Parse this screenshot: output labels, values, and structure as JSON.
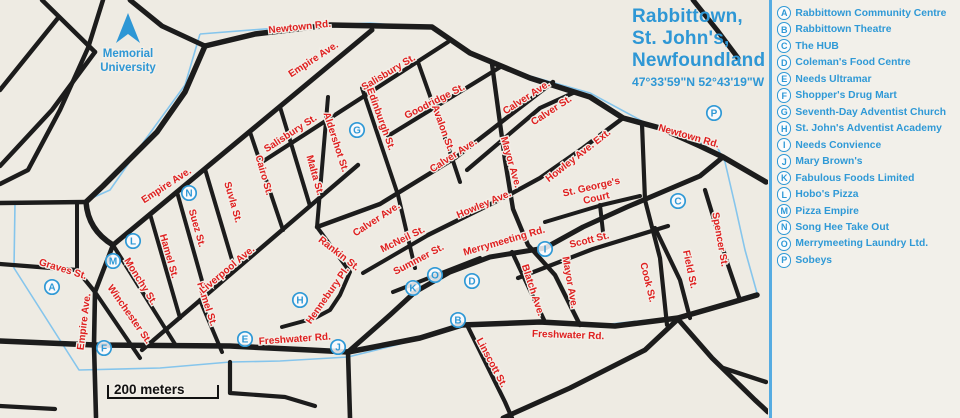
{
  "title": {
    "line1": "Rabbittown,",
    "line2": "St. John's,",
    "line3": "Newfoundland",
    "coordinates": "47°33'59\"N 52°43'19\"W"
  },
  "legend": {
    "items": [
      {
        "letter": "A",
        "label": "Rabbittown Community Centre"
      },
      {
        "letter": "B",
        "label": "Rabbittown Theatre"
      },
      {
        "letter": "C",
        "label": "The HUB"
      },
      {
        "letter": "D",
        "label": "Coleman's Food Centre"
      },
      {
        "letter": "E",
        "label": "Needs Ultramar"
      },
      {
        "letter": "F",
        "label": "Shopper's Drug Mart"
      },
      {
        "letter": "G",
        "label": "Seventh-Day Adventist Church"
      },
      {
        "letter": "H",
        "label": "St. John's Adventist Academy"
      },
      {
        "letter": "I",
        "label": "Needs Convience"
      },
      {
        "letter": "J",
        "label": "Mary Brown's"
      },
      {
        "letter": "K",
        "label": "Fabulous Foods Limited"
      },
      {
        "letter": "L",
        "label": "Hobo's Pizza"
      },
      {
        "letter": "M",
        "label": "Pizza Empire"
      },
      {
        "letter": "N",
        "label": "Song Hee Take Out"
      },
      {
        "letter": "O",
        "label": "Merrymeeting Laundry Ltd."
      },
      {
        "letter": "P",
        "label": "Sobeys"
      }
    ]
  },
  "map": {
    "colors": {
      "background": "#eeebe3",
      "road": "#1c1c1c",
      "boundary": "#85c5ec",
      "street_label": "#df1f1f",
      "marker": "#2f99d6",
      "halo": "#f2efe8"
    },
    "memorial": {
      "lines": [
        "Memorial",
        "University"
      ],
      "x": 128,
      "y": 57,
      "line_height": 14
    },
    "north_arrow": {
      "points": "128,13 116,43 128,34 140,43"
    },
    "scale_bar": {
      "text": "200 meters",
      "path": "M108,385 L108,398 L218,398 L218,385",
      "text_x": 114,
      "text_y": 394
    },
    "boundary_points": "200,34 290,27 370,23 432,28 470,52 530,76 590,93 655,128 700,143 717,147 725,162 735,205 745,250 757,293 677,317 610,324 530,321 460,324 400,344 348,357 280,361 230,362 160,368 79,370 14,268 15,203 83,202 110,190 145,140 185,85 200,34",
    "roads": [
      {
        "d": "M42,0 L95,52",
        "w": 4.5
      },
      {
        "d": "M58,18 L0,90",
        "w": 4.5
      },
      {
        "d": "M95,52 L52,110 L0,166",
        "w": 4.5
      },
      {
        "d": "M103,0 L88,48 L60,110 L28,170 L0,184",
        "w": 4.5
      },
      {
        "d": "M130,0 L162,26 L205,46",
        "w": 5
      },
      {
        "d": "M205,46 L185,92 L157,132 L103,186 L86,202 Q88,230 113,245",
        "w": 5.5
      },
      {
        "d": "M86,202 L0,203",
        "w": 4.5
      },
      {
        "d": "M77,203 L77,269",
        "w": 4
      },
      {
        "d": "M0,264 L77,270 L95,292",
        "w": 4.2
      },
      {
        "d": "M113,245 L95,292 L94,345 L96,417",
        "w": 4.6
      },
      {
        "d": "M95,292 L140,358",
        "w": 4
      },
      {
        "d": "M113,245 L175,344",
        "w": 4
      },
      {
        "d": "M200,300 L222,352",
        "w": 4
      },
      {
        "d": "M205,46 L255,34 L330,25 L432,27 L470,53 L530,78 L590,97 L623,118 L660,128 L700,146 L723,157 L766,182",
        "w": 5.5
      },
      {
        "d": "M113,245 L372,30",
        "w": 5
      },
      {
        "d": "M262,162 L448,42",
        "w": 4.2
      },
      {
        "d": "M142,350 L358,165",
        "w": 4.4
      },
      {
        "d": "M388,136 L502,66",
        "w": 4.2
      },
      {
        "d": "M317,227 L380,204 L455,158 L553,82",
        "w": 4.4
      },
      {
        "d": "M467,170 L540,108 L573,93",
        "w": 4.2
      },
      {
        "d": "M428,235 L507,196 L540,178 L583,148 L623,118",
        "w": 4.4
      },
      {
        "d": "M348,352 L390,315 L415,292 L450,272 L490,257 L545,248 L583,227 L627,207 L667,190 L700,176 L723,157",
        "w": 5
      },
      {
        "d": "M0,341 L95,345 L230,346 L310,350 L348,352",
        "w": 5.5
      },
      {
        "d": "M348,352 L420,338 L462,325 L540,322 L615,326 L678,318 L730,303 L757,295",
        "w": 5.5
      },
      {
        "d": "M250,132 L283,230",
        "w": 4
      },
      {
        "d": "M280,107 L310,206",
        "w": 4
      },
      {
        "d": "M205,169 L235,270",
        "w": 4
      },
      {
        "d": "M177,192 L206,295",
        "w": 4
      },
      {
        "d": "M150,214 L180,318",
        "w": 4
      },
      {
        "d": "M328,97 L317,227",
        "w": 4
      },
      {
        "d": "M362,88 L398,195 L415,268",
        "w": 4
      },
      {
        "d": "M418,62 L452,158 L460,182",
        "w": 4
      },
      {
        "d": "M317,227 L350,272 L340,295 L330,310 L315,318 L282,327",
        "w": 4
      },
      {
        "d": "M363,273 L430,234",
        "w": 4
      },
      {
        "d": "M393,292 L480,258",
        "w": 4
      },
      {
        "d": "M492,64 L505,160 L513,209 L528,245 L555,275 L580,325",
        "w": 4.4
      },
      {
        "d": "M642,124 L645,200 L660,258 L667,325",
        "w": 4.2
      },
      {
        "d": "M545,222 L602,205 L640,196",
        "w": 4
      },
      {
        "d": "M600,205 L603,232",
        "w": 4
      },
      {
        "d": "M518,278 L593,249 L668,226",
        "w": 4.2
      },
      {
        "d": "M655,228 L680,280 L690,318",
        "w": 4.2
      },
      {
        "d": "M705,190 L727,262 L740,300",
        "w": 4.2
      },
      {
        "d": "M693,0 L717,30 L738,58",
        "w": 5
      },
      {
        "d": "M677,318 L712,358 L755,400 L768,412",
        "w": 5
      },
      {
        "d": "M503,418 L570,388 L645,350 L677,320",
        "w": 5
      },
      {
        "d": "M723,368 L766,382",
        "w": 4.4
      },
      {
        "d": "M348,352 L350,418",
        "w": 4.6
      },
      {
        "d": "M230,362 L230,393 L285,397 L315,406",
        "w": 4.2
      },
      {
        "d": "M468,327 L505,402 L512,418",
        "w": 4.2
      },
      {
        "d": "M0,406 L55,409",
        "w": 4.2
      },
      {
        "d": "M512,252 L545,322",
        "w": 4.2
      }
    ],
    "street_labels": [
      {
        "t": "Newtown Rd.",
        "x": 300,
        "y": 30,
        "r": -6
      },
      {
        "t": "Newtown Rd.",
        "x": 688,
        "y": 139,
        "r": 16
      },
      {
        "t": "Empire Ave.",
        "x": 315,
        "y": 62,
        "r": -33
      },
      {
        "t": "Empire Ave.",
        "x": 168,
        "y": 188,
        "r": -33
      },
      {
        "t": "Empire Ave.",
        "x": 87,
        "y": 322,
        "r": -83
      },
      {
        "t": "Salisbury St.",
        "x": 390,
        "y": 75,
        "r": -31
      },
      {
        "t": "Salisbury St.",
        "x": 292,
        "y": 136,
        "r": -33
      },
      {
        "t": "Goodridge St.",
        "x": 436,
        "y": 104,
        "r": -27
      },
      {
        "t": "Edinburgh St.",
        "x": 378,
        "y": 120,
        "r": 70
      },
      {
        "t": "Aldershot St.",
        "x": 333,
        "y": 143,
        "r": 72
      },
      {
        "t": "Avalon St.",
        "x": 440,
        "y": 129,
        "r": 70
      },
      {
        "t": "Cairo St.",
        "x": 261,
        "y": 176,
        "r": 74
      },
      {
        "t": "Malta St.",
        "x": 312,
        "y": 176,
        "r": 74
      },
      {
        "t": "Suvla St.",
        "x": 230,
        "y": 203,
        "r": 74
      },
      {
        "t": "Suez St.",
        "x": 194,
        "y": 229,
        "r": 74
      },
      {
        "t": "Hamel St.",
        "x": 166,
        "y": 257,
        "r": 74
      },
      {
        "t": "Hamel St.",
        "x": 204,
        "y": 305,
        "r": 72
      },
      {
        "t": "Monchy St.",
        "x": 138,
        "y": 283,
        "r": 58
      },
      {
        "t": "Winchester St.",
        "x": 127,
        "y": 316,
        "r": 55
      },
      {
        "t": "Graves St.",
        "x": 62,
        "y": 272,
        "r": 17
      },
      {
        "t": "Liverpool Ave.",
        "x": 229,
        "y": 272,
        "r": -40
      },
      {
        "t": "Rankin St.",
        "x": 337,
        "y": 256,
        "r": 38
      },
      {
        "t": "Hennebury Pl.",
        "x": 330,
        "y": 297,
        "r": -55
      },
      {
        "t": "McNeil St.",
        "x": 404,
        "y": 242,
        "r": -26
      },
      {
        "t": "Summer St.",
        "x": 420,
        "y": 262,
        "r": -28
      },
      {
        "t": "Calver Ave.",
        "x": 528,
        "y": 100,
        "r": -33
      },
      {
        "t": "Calver St.",
        "x": 553,
        "y": 113,
        "r": -33
      },
      {
        "t": "Calver Ave.",
        "x": 455,
        "y": 158,
        "r": -33
      },
      {
        "t": "Calver Ave.",
        "x": 378,
        "y": 222,
        "r": -33
      },
      {
        "t": "Mayor Ave.",
        "x": 508,
        "y": 163,
        "r": 74
      },
      {
        "t": "Mayor Ave.",
        "x": 567,
        "y": 283,
        "r": 80
      },
      {
        "t": "Howley Ave. Ext.",
        "x": 580,
        "y": 158,
        "r": -38
      },
      {
        "t": "Howley Ave.",
        "x": 485,
        "y": 207,
        "r": -23
      },
      {
        "t": "St. George's",
        "x": 592,
        "y": 190,
        "r": -13
      },
      {
        "t": "Court",
        "x": 597,
        "y": 201,
        "r": -13
      },
      {
        "t": "Merrymeeting Rd.",
        "x": 505,
        "y": 244,
        "r": -16
      },
      {
        "t": "Scott St.",
        "x": 590,
        "y": 243,
        "r": -14
      },
      {
        "t": "Blatch Ave.",
        "x": 530,
        "y": 291,
        "r": 72
      },
      {
        "t": "Cook St.",
        "x": 645,
        "y": 283,
        "r": 76
      },
      {
        "t": "Field St.",
        "x": 687,
        "y": 270,
        "r": 78
      },
      {
        "t": "Spencer St.",
        "x": 717,
        "y": 240,
        "r": 80
      },
      {
        "t": "Freshwater Rd.",
        "x": 295,
        "y": 342,
        "r": -4
      },
      {
        "t": "Freshwater Rd.",
        "x": 568,
        "y": 338,
        "r": 2
      },
      {
        "t": "Linscott St.",
        "x": 489,
        "y": 364,
        "r": 62
      }
    ],
    "markers": [
      {
        "l": "A",
        "x": 52,
        "y": 287
      },
      {
        "l": "B",
        "x": 458,
        "y": 320
      },
      {
        "l": "C",
        "x": 678,
        "y": 201
      },
      {
        "l": "D",
        "x": 472,
        "y": 281
      },
      {
        "l": "E",
        "x": 245,
        "y": 339
      },
      {
        "l": "F",
        "x": 104,
        "y": 348
      },
      {
        "l": "G",
        "x": 357,
        "y": 130
      },
      {
        "l": "H",
        "x": 300,
        "y": 300
      },
      {
        "l": "I",
        "x": 545,
        "y": 249
      },
      {
        "l": "J",
        "x": 338,
        "y": 347
      },
      {
        "l": "K",
        "x": 413,
        "y": 288
      },
      {
        "l": "L",
        "x": 133,
        "y": 241
      },
      {
        "l": "M",
        "x": 113,
        "y": 261
      },
      {
        "l": "N",
        "x": 189,
        "y": 193
      },
      {
        "l": "O",
        "x": 435,
        "y": 275
      },
      {
        "l": "P",
        "x": 714,
        "y": 113
      }
    ]
  }
}
